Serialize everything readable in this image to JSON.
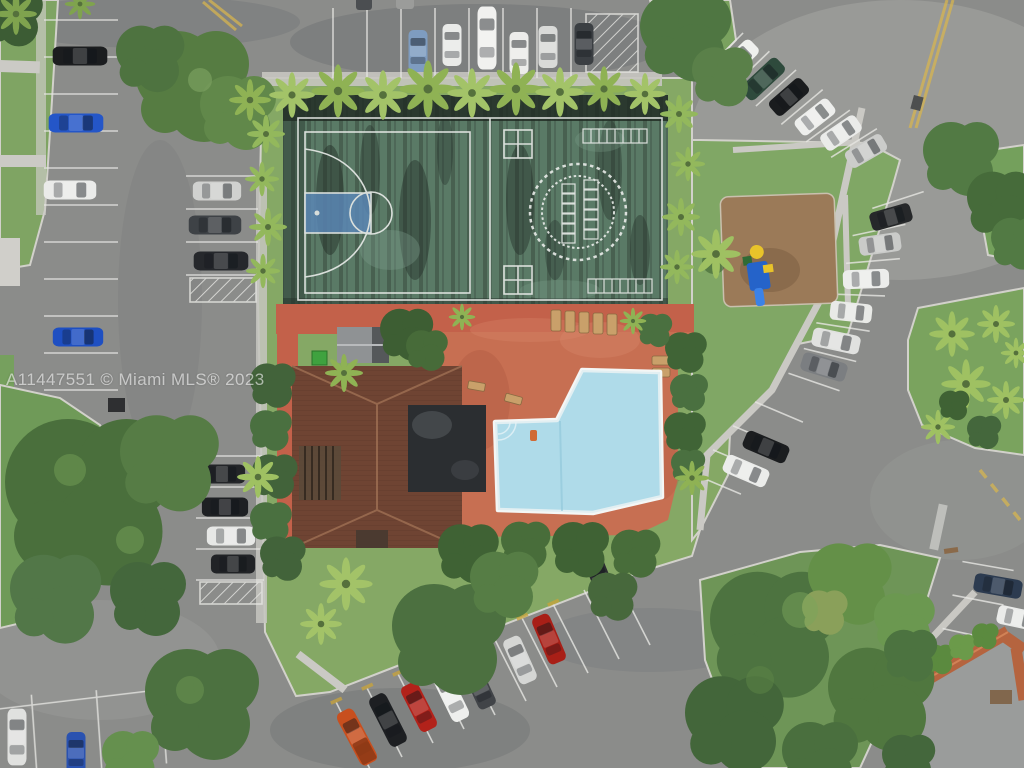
{
  "meta": {
    "type": "aerial-drone-photo",
    "subject": "Overhead view of a condo community amenity area: sports courts, swimming pool, clubhouse, playground and surrounding parking lots"
  },
  "watermark": {
    "text": "A11447551 © Miami MLS® 2023",
    "color": "rgba(255,255,255,0.58)"
  },
  "palette": {
    "asphalt": "#8b8c8a",
    "grass": "#7fa463",
    "court_green": "#5a7a66",
    "court_stain": "#222e27",
    "court_line": "#e9ece9",
    "basketball_key_blue": "#5b87b8",
    "pool_water": "#a6d7e6",
    "pool_border": "#f4f6f5",
    "pool_deck_terracotta": "#c76f52",
    "clubhouse_roof_brown": "#6f4433",
    "flat_roof_black": "#2b2e31",
    "tiki_hut_gray": "#8f9294",
    "corner_roof_orange": "#b5643f",
    "mulch_brown": "#9b7a58",
    "sidewalk": "#cbcac5",
    "yellow_paint": "#d9b64e",
    "stall_line_white": "#e7e7e3"
  },
  "scene": {
    "sports_court": {
      "left_half": "basketball half-court, white lines, blue painted key",
      "right_half": "game court: two four-square grids, dashed double-circle track with hopscotch grids inside, two shuffleboard score ladders",
      "surface": "weathered dark green with black staining"
    },
    "pool_area": {
      "pool_shape": "irregular boot/L shape with white coping and corner steps",
      "deck": "terracotta painted deck with lounge chairs, benches and potted palms"
    },
    "buildings": {
      "clubhouse": "brown tile hip roof with black flat roof section and pergola",
      "tiki_hut": "small gray-roof hut beside green dumpster",
      "corner_building": "orange Spanish-tile roof building at bottom-right"
    },
    "playground": {
      "surface": "brown mulch bed",
      "equipment_colors": [
        "blue",
        "yellow",
        "green"
      ]
    },
    "landscaping": [
      "palm row along top of courts",
      "palms flanking court sides",
      "large canopy trees bottom-left and bottom-right",
      "teardrop grass island with palms at right",
      "grass triangle with playground"
    ],
    "road_markings": [
      "white parking stall lines",
      "white hatched no-parking zones",
      "yellow curb median stripes",
      "yellow dashed centerline",
      "yellow wheel stops",
      "white median stripe"
    ],
    "parking": {
      "vehicle_count": 45,
      "areas": [
        {
          "name": "top-row",
          "vehicles": [
            "light-blue",
            "white",
            "white-van",
            "white",
            "silver",
            "dark-gray",
            "two-partial-roofs"
          ]
        },
        {
          "name": "left-aisle-west",
          "vehicles": [
            "black",
            "blue",
            "white",
            "blue"
          ]
        },
        {
          "name": "left-aisle-east",
          "vehicles": [
            "silver",
            "dark-pickup",
            "black-suv",
            "black-suv",
            "black",
            "white",
            "black"
          ]
        },
        {
          "name": "bottom-left-corner",
          "vehicles": [
            "white",
            "blue"
          ]
        },
        {
          "name": "bottom-angled-row",
          "vehicles": [
            "orange-truck",
            "black-suv",
            "red",
            "white-van",
            "dark-gray",
            "silver",
            "red",
            "dark"
          ]
        },
        {
          "name": "right-curved-row",
          "vehicles": [
            "white-suv",
            "dark-green-suv",
            "black",
            "white",
            "white",
            "silver",
            "dark",
            "silver",
            "white-suv",
            "white",
            "white-pickup",
            "gray-suv"
          ]
        },
        {
          "name": "middle-right-pair",
          "vehicles": [
            "black",
            "white"
          ]
        },
        {
          "name": "bottom-right-edge",
          "vehicles": [
            "dark-blue",
            "white"
          ]
        }
      ]
    }
  }
}
